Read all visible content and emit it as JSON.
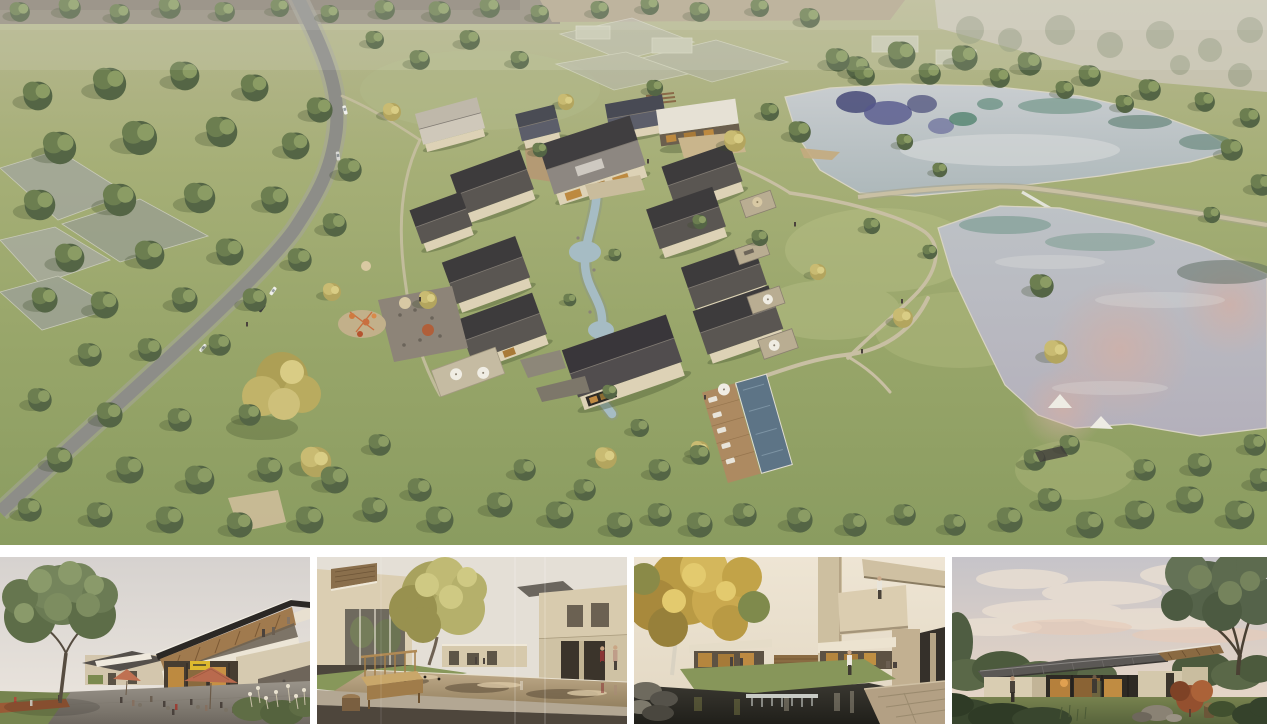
{
  "board": {
    "main_render": {
      "caption": "Aerial rendering of a pitched-roof resort village among trees, with a winding road on the left, a stream and pool through the centre, and two reflective ponds on the right"
    },
    "thumbnails": [
      {
        "caption": "Cafe plaza beneath a two-storey timber-canopy building with rust umbrellas and visitors"
      },
      {
        "caption": "Courtyard houses around a shallow reflecting pond with a wooden bench in the foreground"
      },
      {
        "caption": "Autumn tree and cantilevered guest wing above a dark garden stream with a small weir"
      },
      {
        "caption": "Single-storey glass pavilion glowing at dusk under a large tree"
      }
    ]
  },
  "palette": {
    "grass_top": "#b9bb95",
    "grass": "#a4ae74",
    "grass_deep": "#8b9d60",
    "tree_dark": "#546545",
    "tree_mid": "#6c7e50",
    "tree_light": "#8b9c64",
    "autumn": "#c1b369",
    "roof_dark": "#3d3b3c",
    "roof_mid": "#5a5652",
    "roof_pale": "#ccc5b8",
    "wall": "#ddd2b6",
    "wall_shade": "#b9ac8e",
    "road": "#8d8d88",
    "path": "#c8bfa3",
    "water_upper": "#c3c9cb",
    "water_lower": "#b9bec4",
    "water_teal": "#6e9486",
    "water_purple": "#4e4a78",
    "water_pink": "#cda9a0",
    "stream": "#a6bcc4",
    "pool": "#5d7486",
    "haze": "#cdc7ba",
    "sand": "#c4ab7e",
    "umbrella_rust": "#b96a4e",
    "wood": "#a07a4e",
    "stone": "#6e655a",
    "dusk_sky": "#c6c4c9",
    "dusk_warm": "#ead9c6",
    "interior_glow": "#bd8a40"
  }
}
